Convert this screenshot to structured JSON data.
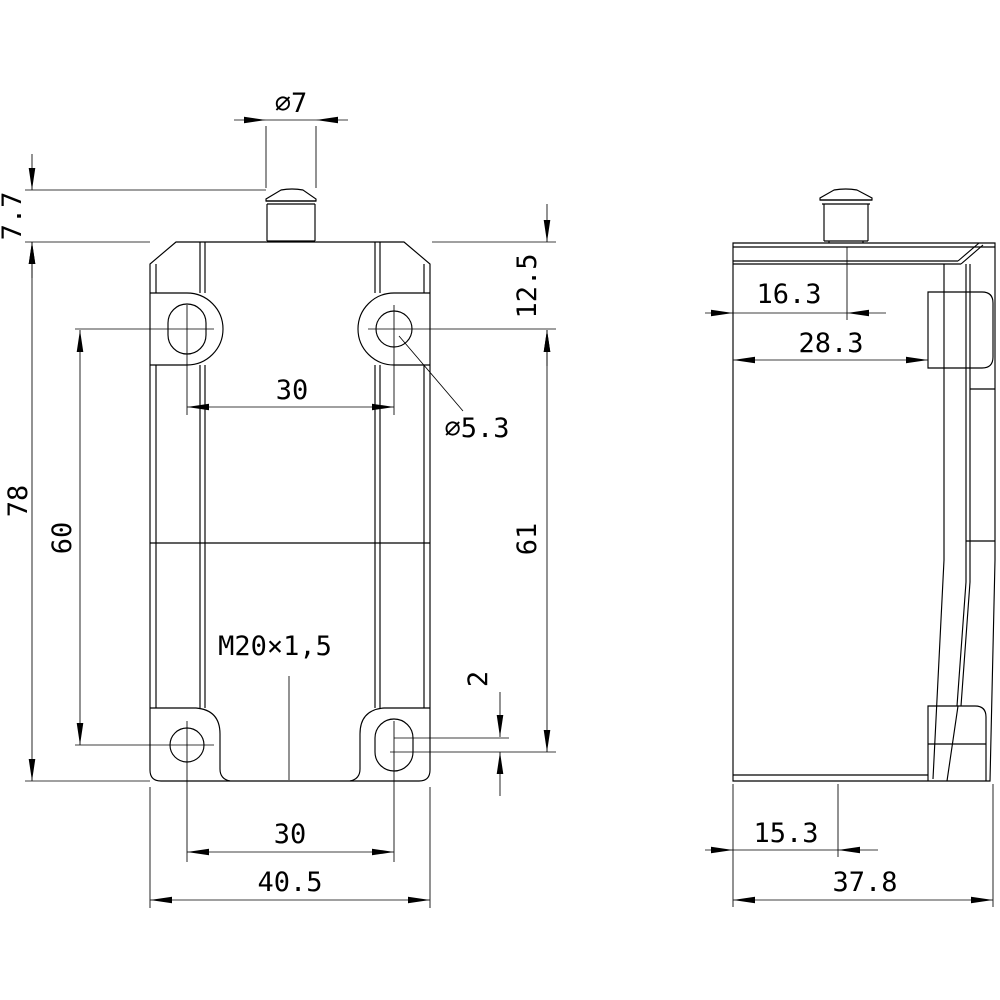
{
  "drawing": {
    "type": "technical-dimension-drawing",
    "background": "#ffffff",
    "line_color": "#000000"
  },
  "front_view": {
    "dims": {
      "plunger_dia": "∅7",
      "pretravel": "7.7",
      "height": "78",
      "hole_pitch_vertical": "60",
      "hole_pitch_top": "30",
      "top_hole_offset": "12.5",
      "hole_dia": "∅5.3",
      "hole_span_vertical": "61",
      "slot_elongation": "2",
      "conduit_thread": "M20×1,5",
      "hole_pitch_bottom": "30",
      "width": "40.5"
    }
  },
  "side_view": {
    "dims": {
      "plunger_offset": "16.3",
      "upper_depth": "28.3",
      "base_offset": "15.3",
      "depth": "37.8"
    }
  }
}
